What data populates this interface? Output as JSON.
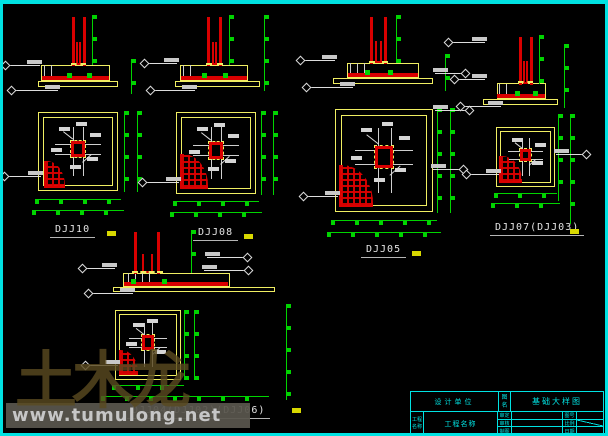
{
  "palette": {
    "frame_cyan": "#00e2e2",
    "line_yellow": "#f0ee62",
    "line_red": "#d90000",
    "line_green": "#00d400",
    "line_white": "#dddddd",
    "background": "#000000"
  },
  "details": [
    {
      "label": "DJJ10"
    },
    {
      "label": "DJJ08"
    },
    {
      "label": "DJJ05"
    },
    {
      "label": "DJJ07(DJJ03)"
    },
    {
      "label": "DJJ04(DJJ02)(DJJ06)"
    }
  ],
  "watermark": {
    "logo": "土木龙",
    "url": "www.tumulong.net"
  },
  "title_block": {
    "org": "设计单位",
    "project": "工程名称",
    "drawing_label": "图名",
    "title": "基础大样图",
    "fields": [
      {
        "label": "审定",
        "value": ""
      },
      {
        "label": "图号",
        "value": ""
      },
      {
        "label": "审核",
        "value": ""
      },
      {
        "label": "比例",
        "value": ""
      },
      {
        "label": "制图",
        "value": ""
      },
      {
        "label": "日期",
        "value": ""
      }
    ]
  }
}
